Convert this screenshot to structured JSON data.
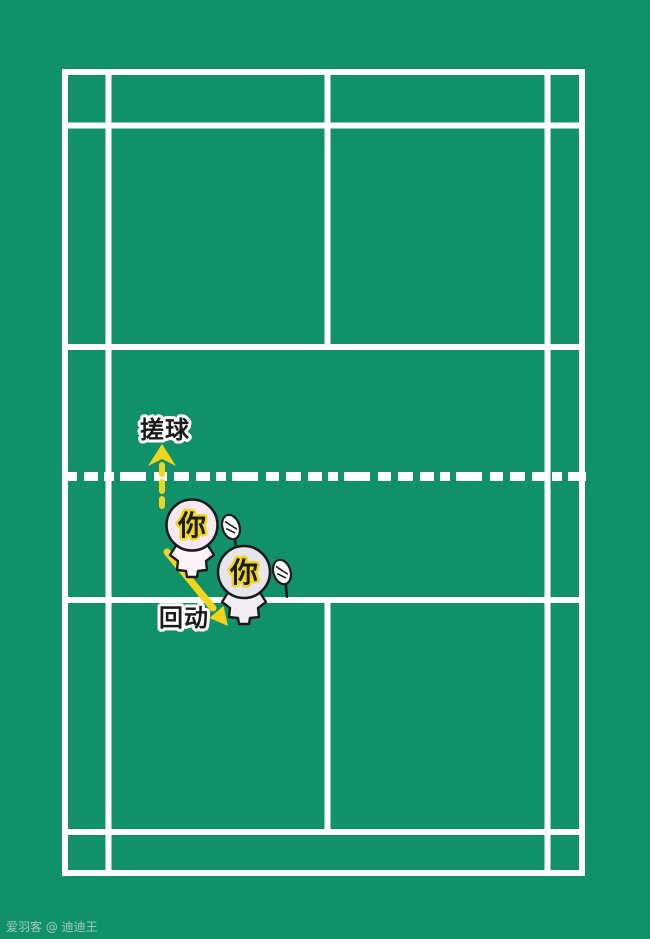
{
  "labels": {
    "drop_shot": "搓球",
    "recover": "回动"
  },
  "players": [
    {
      "label": "你"
    },
    {
      "label": "你"
    }
  ],
  "watermark": "爱羽客 @ 迪迪王",
  "colors": {
    "court_green": "#10916a",
    "line_white": "#ffffff",
    "arrow_yellow": "#f2d41c",
    "glow_yellow": "#f1d71e",
    "ink_black": "#1b1b1b",
    "player_start_head": "#f8e8f0",
    "player_start_body": "#fdf4f9",
    "player_end_head": "#e7e5ec",
    "player_end_body": "#f1eff5",
    "watermark_gray": "#ccd6d2"
  }
}
